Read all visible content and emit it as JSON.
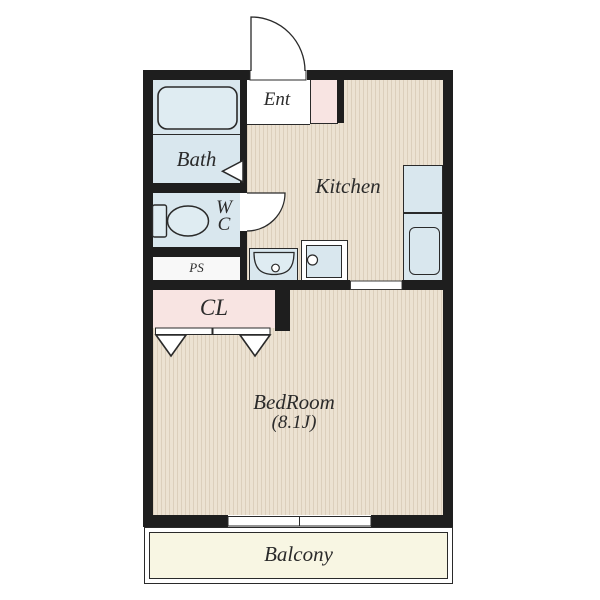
{
  "floorplan": {
    "rooms": {
      "ent": {
        "label": "Ent"
      },
      "bath": {
        "label": "Bath"
      },
      "wc": {
        "label_line1": "W",
        "label_line2": "C"
      },
      "ps": {
        "label": "PS"
      },
      "cl": {
        "label": "CL"
      },
      "kitchen": {
        "label": "Kitchen"
      },
      "bedroom": {
        "label": "BedRoom",
        "size": "(8.1J)"
      },
      "balcony": {
        "label": "Balcony"
      }
    },
    "colors": {
      "wall": "#1e1e1e",
      "water": "#d9e7ee",
      "fixture": "#dfecf2",
      "floor_base": "#ece2d2",
      "floor_stripe": "#dccfbc",
      "pink": "#f8e4e2",
      "balcony": "#f8f6e3",
      "ink": "#2b2b2b"
    }
  }
}
